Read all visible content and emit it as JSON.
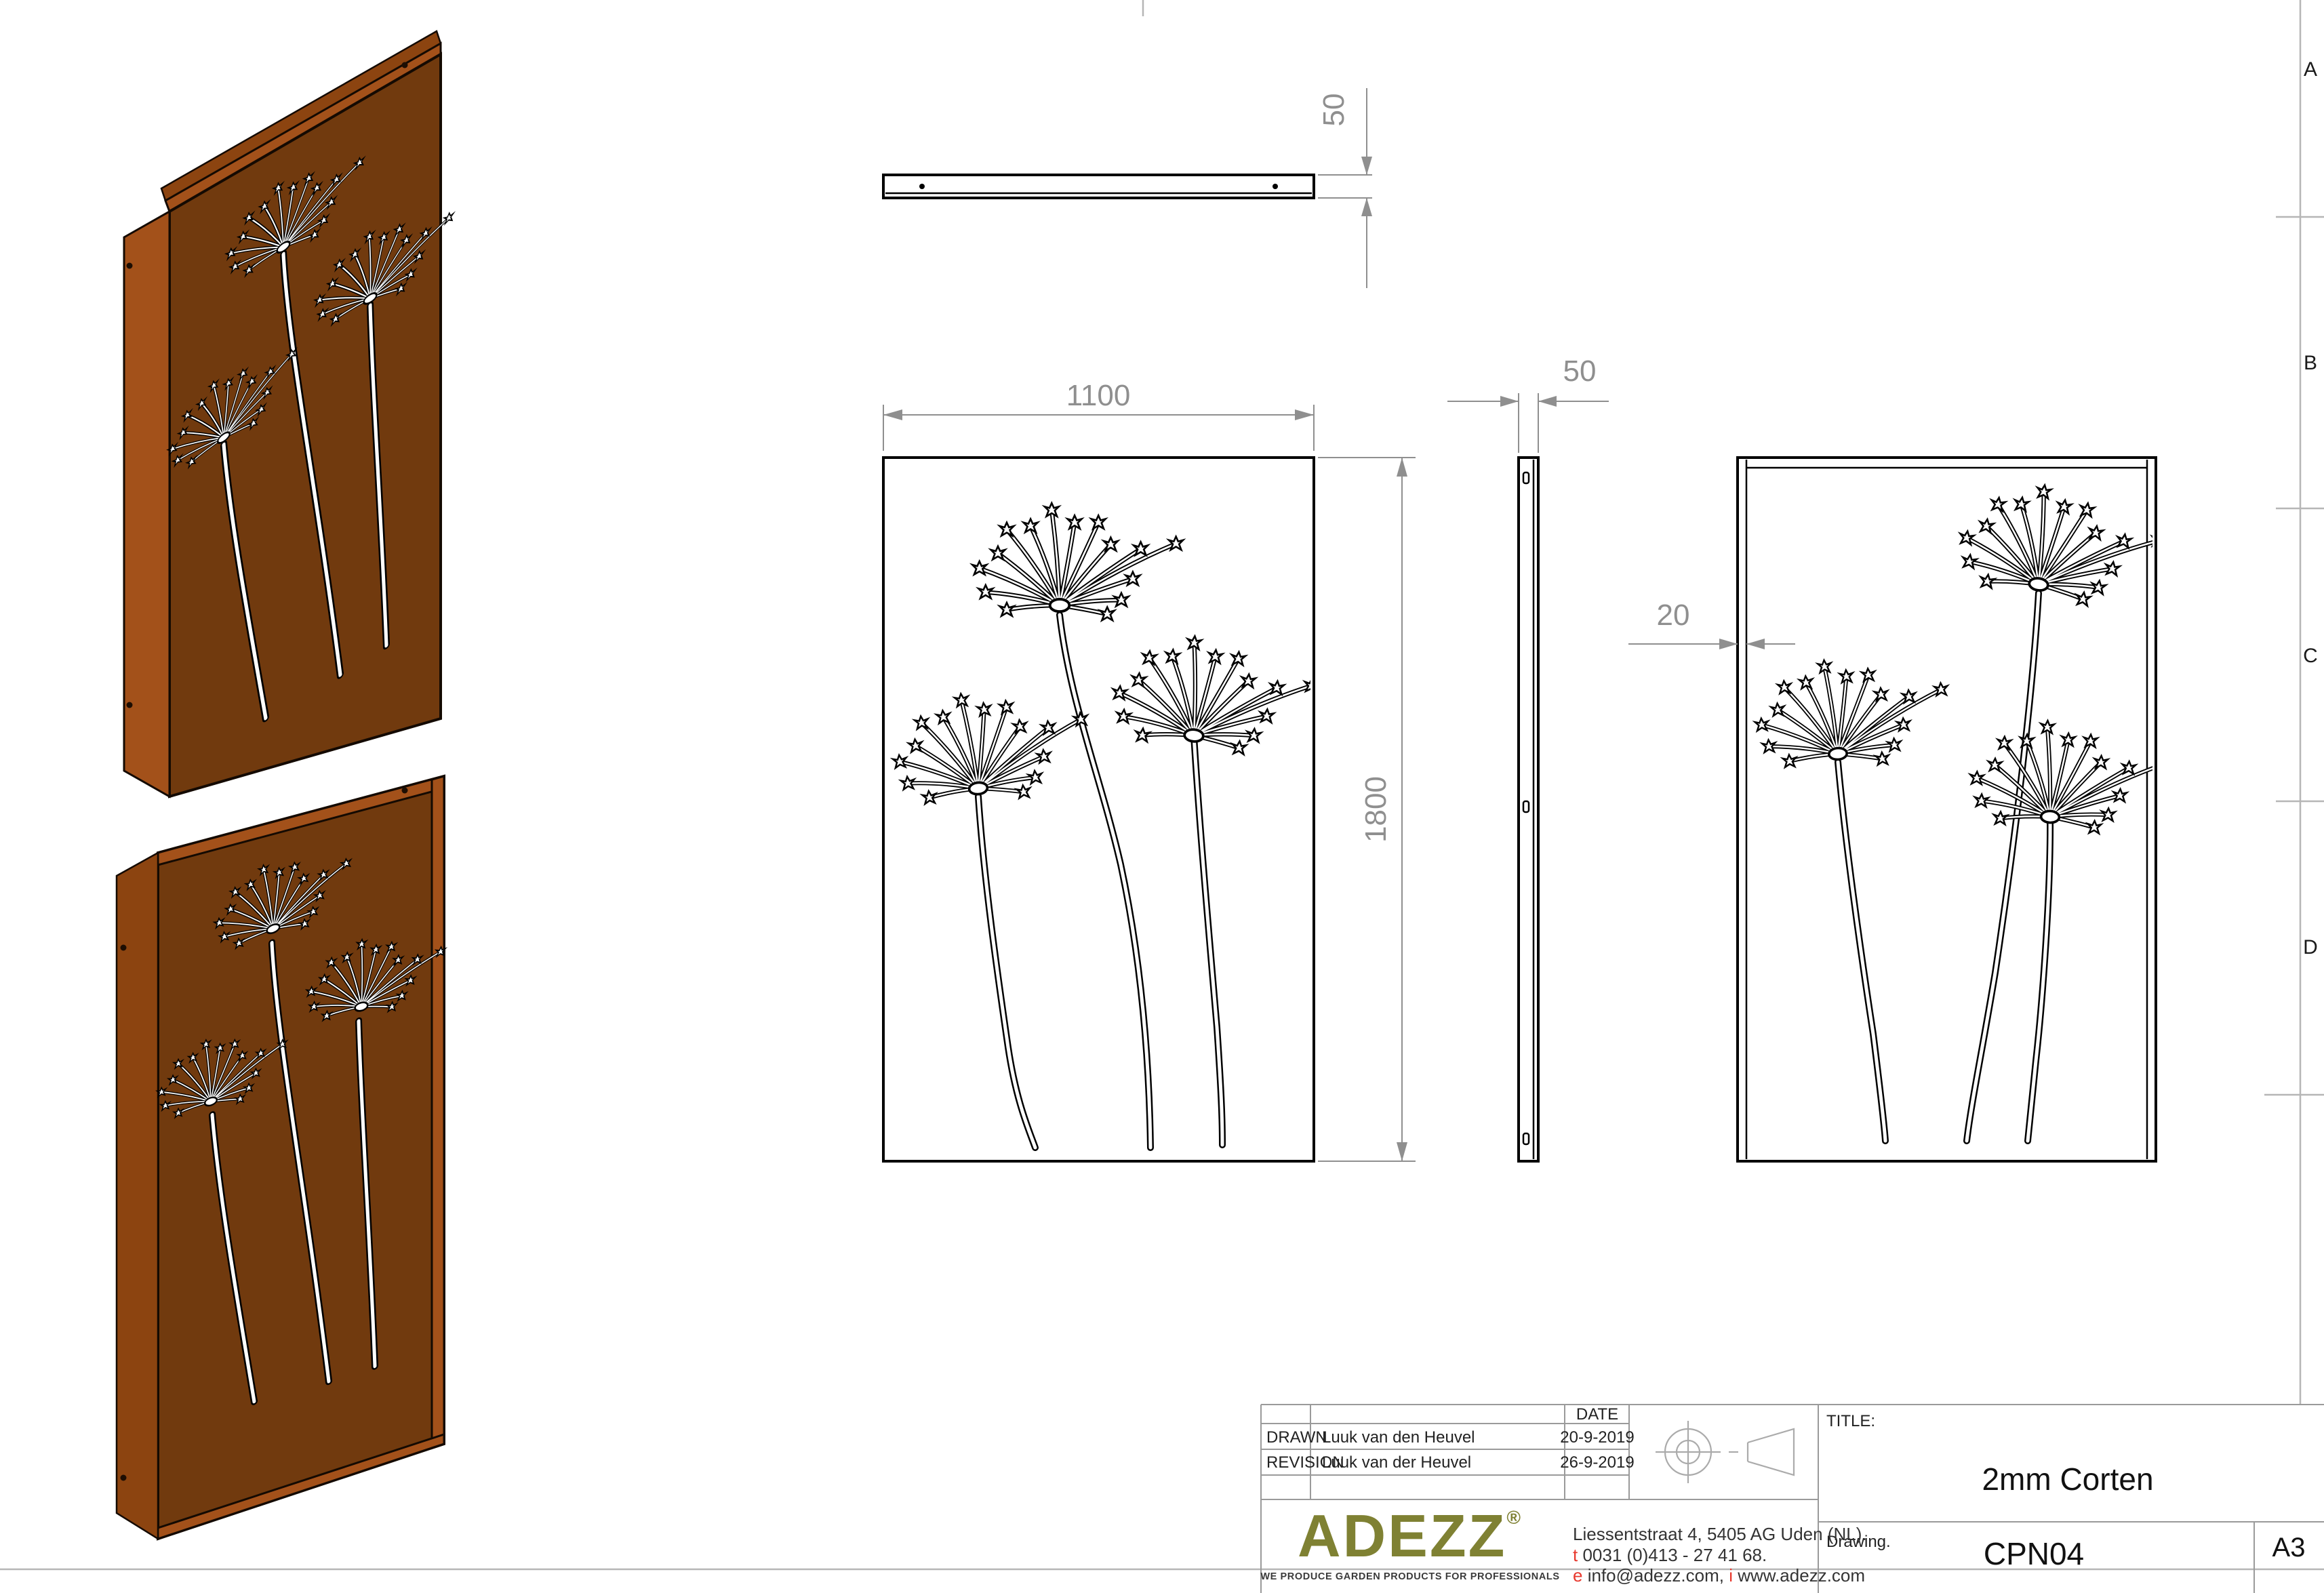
{
  "frame": {
    "zones": [
      "A",
      "B",
      "C",
      "D"
    ]
  },
  "views": {
    "top": {
      "thickness_dim": "50"
    },
    "front": {
      "width_dim": "1100",
      "height_dim": "1800"
    },
    "side": {
      "thickness_dim": "50"
    },
    "back": {
      "edge_dim": "20"
    }
  },
  "title_block": {
    "date_header": "DATE",
    "rows": [
      {
        "label": "DRAWN",
        "name": "Luuk van den Heuvel",
        "date": "20-9-2019"
      },
      {
        "label": "REVISION",
        "name": "Luuk van der Heuvel",
        "date": "26-9-2019"
      }
    ],
    "title_label": "TITLE:",
    "title_value": "2mm Corten",
    "drawing_label": "Drawing.",
    "drawing_value": "CPN04",
    "sheet_size": "A3",
    "logo": {
      "text": "ADEZZ",
      "reg": "®",
      "tagline": "WE PRODUCE GARDEN PRODUCTS FOR PROFESSIONALS"
    },
    "address": {
      "line1": "Liessentstraat 4, 5405 AG Uden (NL).",
      "phone_prefix": "t",
      "phone_rest": " 0031 (0)413 - 27 41 68.",
      "email_prefix": "e",
      "email_rest": " info@adezz.com, ",
      "web_prefix": "i",
      "web_rest": " www.adezz.com"
    }
  },
  "colors": {
    "corten_face": "#713A0E",
    "corten_edge": "#A3511A",
    "logo_olive": "#7F8133",
    "accent_red": "#E8382D",
    "dim_gray": "#8F8F8F"
  }
}
